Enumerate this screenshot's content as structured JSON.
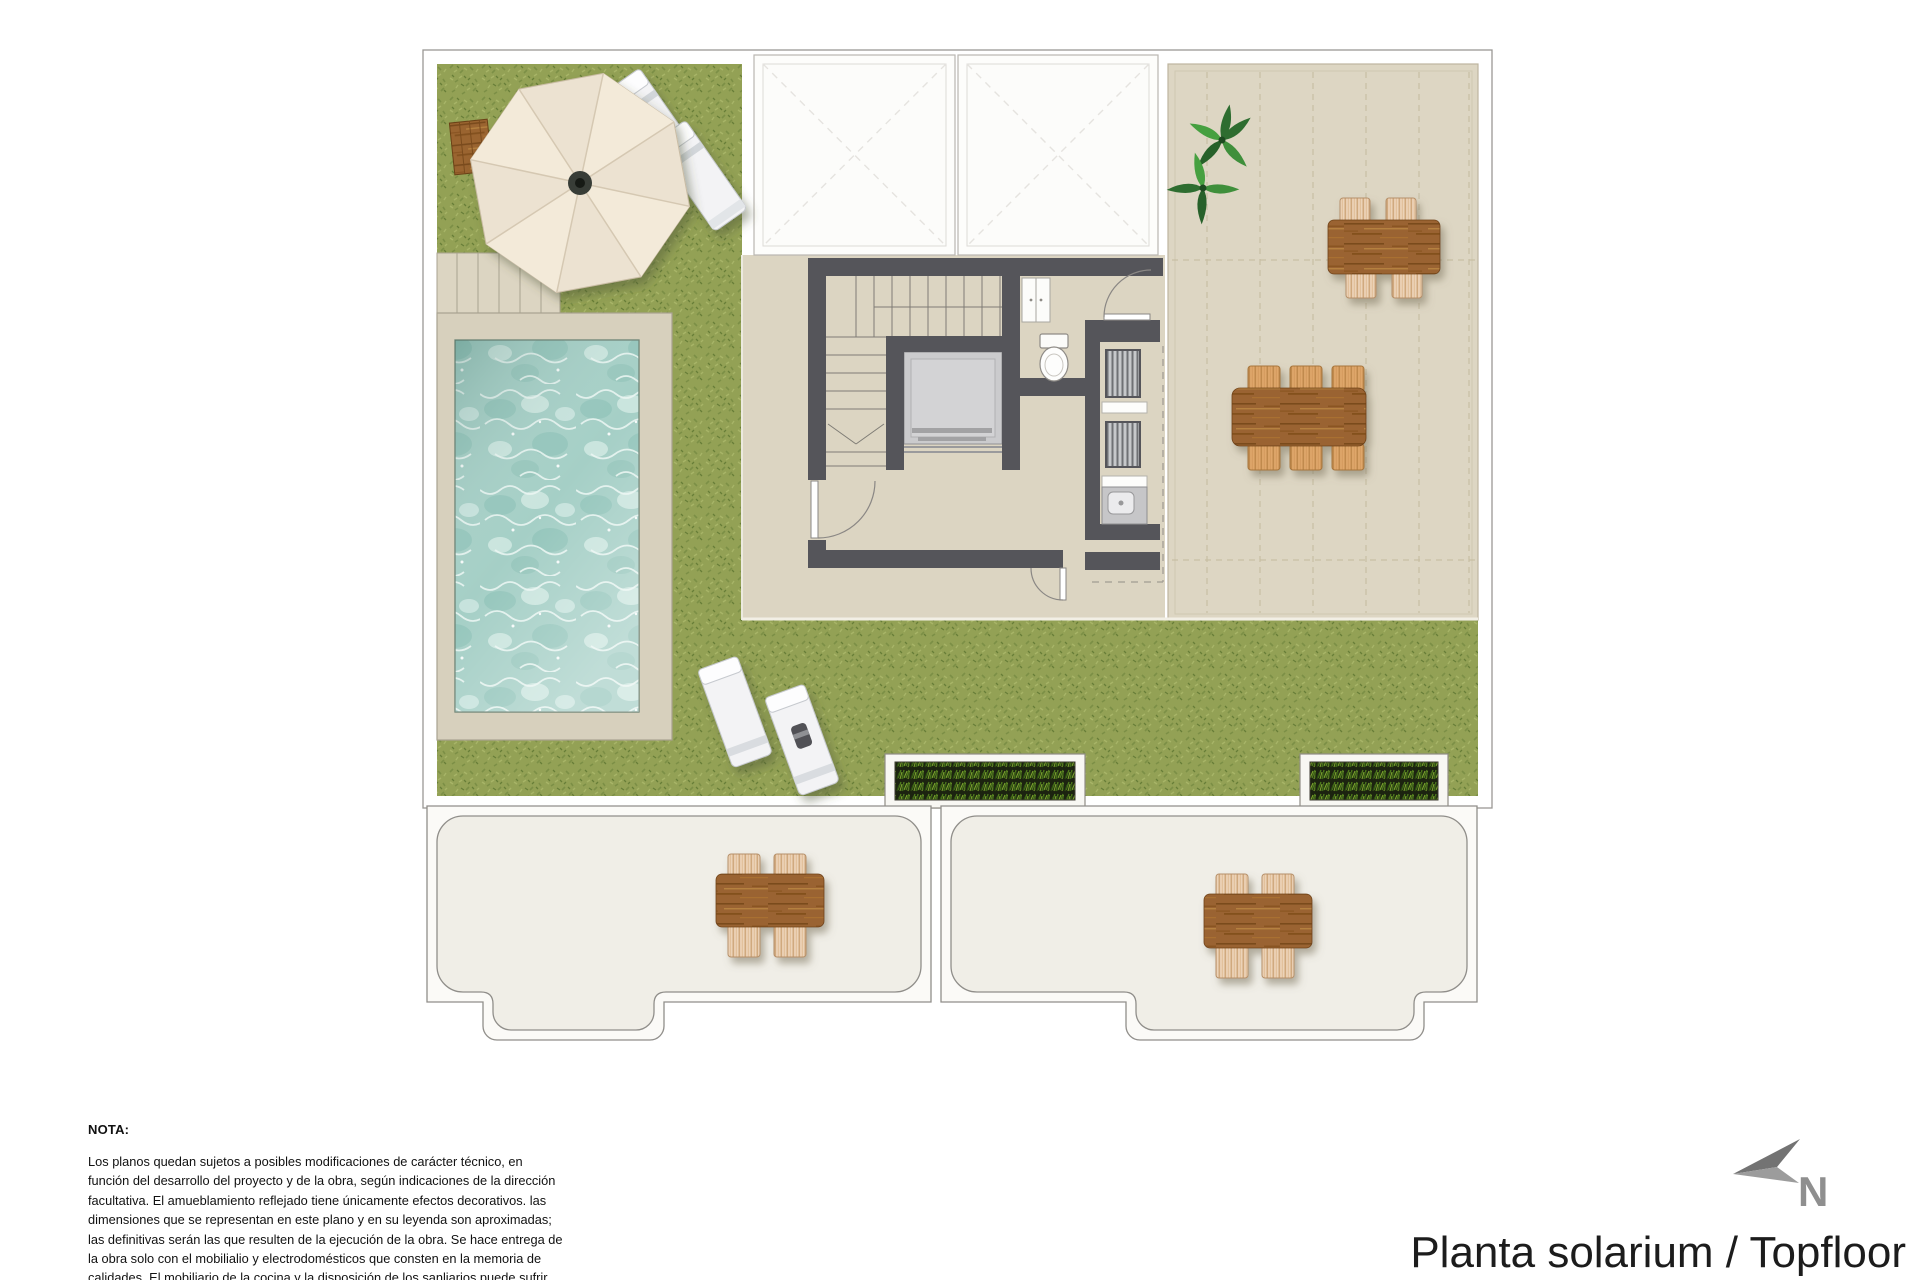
{
  "title": "Planta solarium / Topfloor",
  "north": {
    "label": "N"
  },
  "note": {
    "heading": "NOTA:",
    "body": "Los planos quedan sujetos a posibles modificaciones de carácter técnico, en función del desarrollo del proyecto y de la obra, según indicaciones de la dirección facultativa. El amueblamiento reflejado tiene únicamente efectos decorativos. las dimensiones que se representan en este plano y en su leyenda son aproximadas; las definitivas serán las que resulten de la ejecución de la obra. Se hace entrega de la obra solo con el mobilialio y electrodomésticos que consten en la memoria de calidades. El mobiliario de la cocina y la disposición de los sanliarios puede sufrir ligeras variaciones en función del montaje definitivo."
  },
  "palette": {
    "page": "#ffffff",
    "grass": "#93a155",
    "terrace": "#dcd5c2",
    "pool_water": "#a5cfc6",
    "walls": "#55555a",
    "wood": "#9a6430",
    "wicker": "#ecd3b8",
    "lower_floor": "#f0eee7"
  }
}
